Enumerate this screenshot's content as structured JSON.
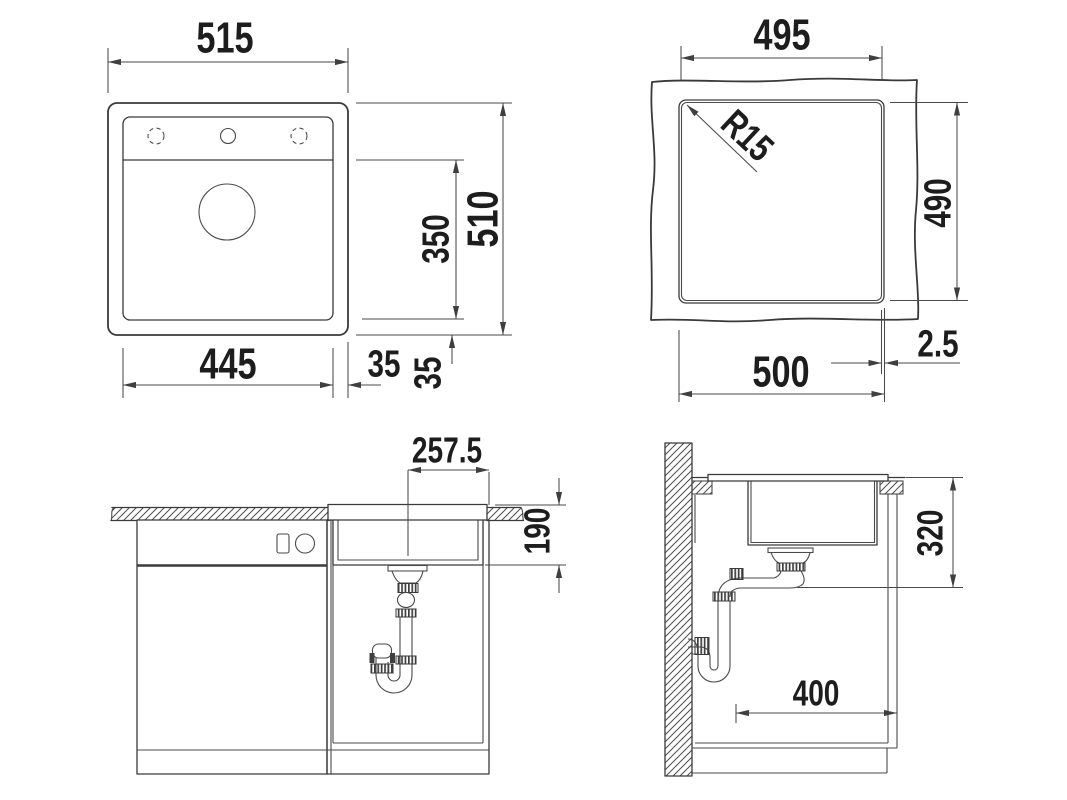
{
  "drawing": {
    "views": {
      "plan": {
        "name": "sink top view",
        "dims": {
          "overall_width": "515",
          "overall_depth": "510",
          "bowl_depth": "350",
          "bowl_width": "445",
          "rim_side": "35",
          "rim_back": "35"
        }
      },
      "cutout": {
        "name": "countertop cutout view",
        "dims": {
          "top_width": "495",
          "corner_radius": "R15",
          "side_height": "490",
          "bottom_width": "500",
          "edge_gap": "2.5"
        }
      },
      "front": {
        "name": "front section view",
        "dims": {
          "center_to_edge": "257.5",
          "bowl_depth": "190"
        }
      },
      "side": {
        "name": "side section view",
        "dims": {
          "required_depth": "320",
          "base_width": "400"
        }
      }
    }
  }
}
